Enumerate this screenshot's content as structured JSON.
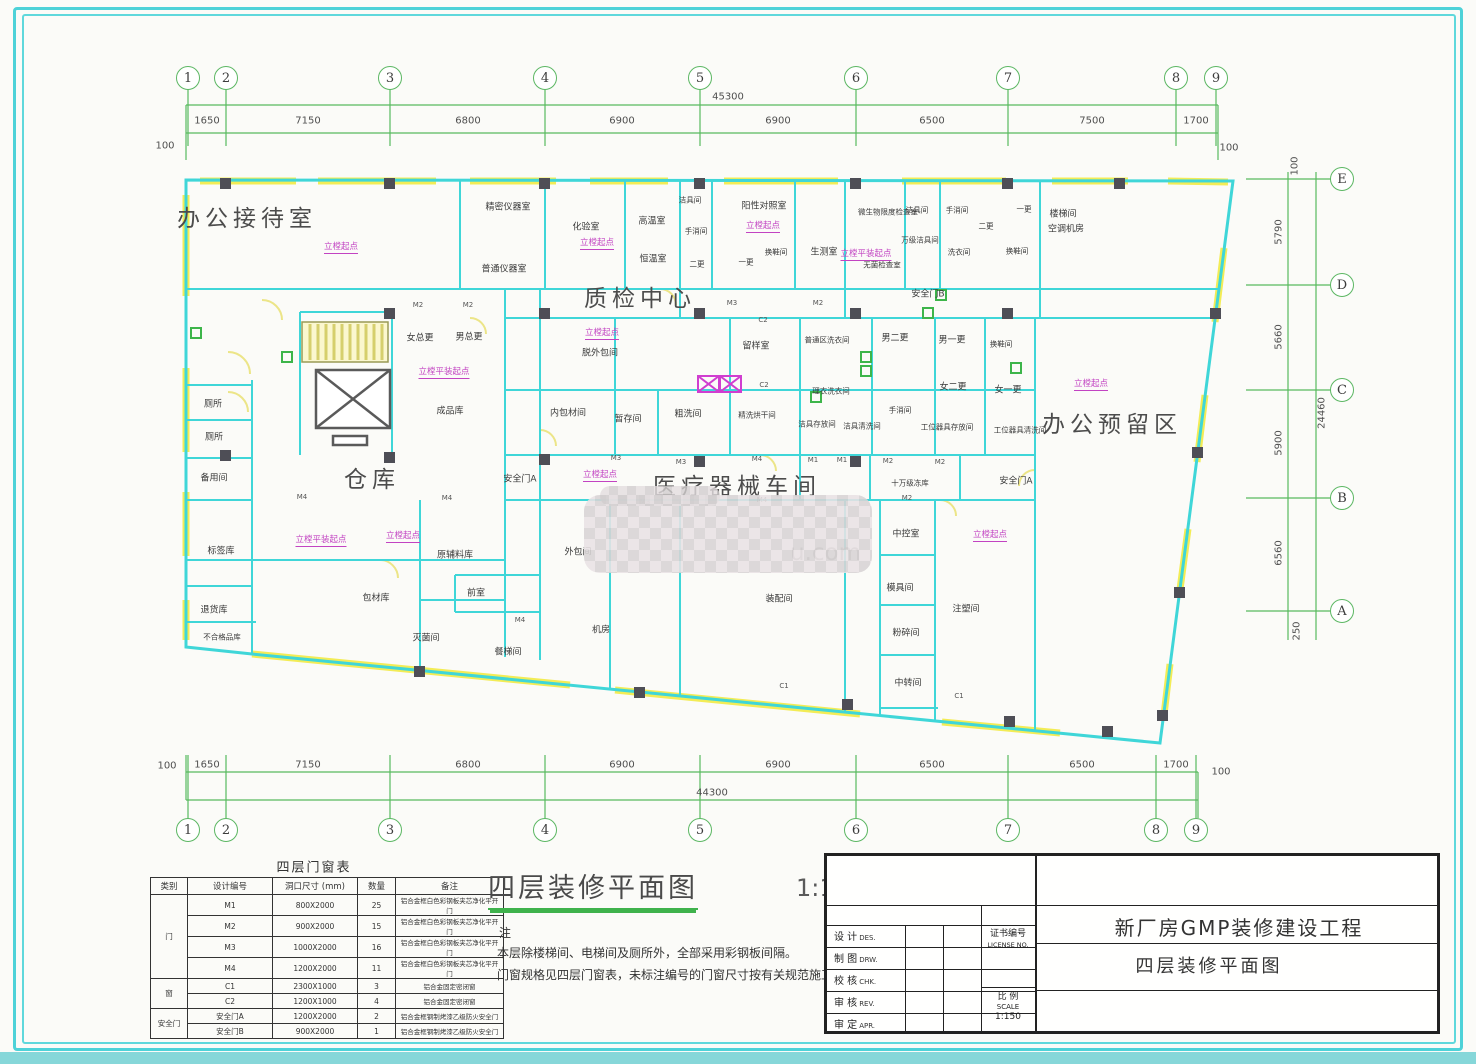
{
  "plan_title": {
    "text": "四层装修平面图",
    "scale": "1:150"
  },
  "watermark": {
    "text": "u.com"
  },
  "notes": {
    "marker": "注",
    "lines": [
      "本层除楼梯间、电梯间及厕所外，全部采用彩钢板间隔。",
      "门窗规格见四层门窗表，未标注编号的门窗尺寸按有关规范施工。"
    ]
  },
  "axes": {
    "top": {
      "items": [
        {
          "n": "1",
          "x": 188
        },
        {
          "n": "2",
          "x": 226
        },
        {
          "n": "3",
          "x": 390
        },
        {
          "n": "4",
          "x": 545
        },
        {
          "n": "5",
          "x": 700
        },
        {
          "n": "6",
          "x": 856
        },
        {
          "n": "7",
          "x": 1008
        },
        {
          "n": "8",
          "x": 1176
        },
        {
          "n": "9",
          "x": 1216
        }
      ],
      "dims": [
        {
          "v": "1650",
          "x": 207
        },
        {
          "v": "7150",
          "x": 308
        },
        {
          "v": "6800",
          "x": 468
        },
        {
          "v": "6900",
          "x": 622
        },
        {
          "v": "6900",
          "x": 778
        },
        {
          "v": "6500",
          "x": 932
        },
        {
          "v": "7500",
          "x": 1092
        },
        {
          "v": "1700",
          "x": 1196
        }
      ],
      "total": {
        "v": "45300",
        "x": 728,
        "y": 97
      },
      "ends": [
        {
          "v": "100",
          "x": 165,
          "y": 146
        },
        {
          "v": "100",
          "x": 1229,
          "y": 148
        }
      ]
    },
    "bottom": {
      "items": [
        {
          "n": "1",
          "x": 188
        },
        {
          "n": "2",
          "x": 226
        },
        {
          "n": "3",
          "x": 390
        },
        {
          "n": "4",
          "x": 545
        },
        {
          "n": "5",
          "x": 700
        },
        {
          "n": "6",
          "x": 856
        },
        {
          "n": "7",
          "x": 1008
        },
        {
          "n": "8",
          "x": 1156
        },
        {
          "n": "9",
          "x": 1196
        }
      ],
      "dims": [
        {
          "v": "1650",
          "x": 207
        },
        {
          "v": "7150",
          "x": 308
        },
        {
          "v": "6800",
          "x": 468
        },
        {
          "v": "6900",
          "x": 622
        },
        {
          "v": "6900",
          "x": 778
        },
        {
          "v": "6500",
          "x": 932
        },
        {
          "v": "6500",
          "x": 1082
        },
        {
          "v": "1700",
          "x": 1176
        }
      ],
      "total": {
        "v": "44300",
        "x": 712,
        "y": 793
      },
      "ends": [
        {
          "v": "100",
          "x": 167,
          "y": 766
        },
        {
          "v": "100",
          "x": 1221,
          "y": 772
        }
      ]
    },
    "right": {
      "items": [
        {
          "n": "E",
          "y": 179
        },
        {
          "n": "D",
          "y": 285
        },
        {
          "n": "C",
          "y": 390
        },
        {
          "n": "B",
          "y": 498
        },
        {
          "n": "A",
          "y": 611
        }
      ],
      "dims": [
        {
          "v": "100",
          "x": 1295,
          "y": 166
        },
        {
          "v": "5790",
          "x": 1279,
          "y": 232
        },
        {
          "v": "5660",
          "x": 1279,
          "y": 337
        },
        {
          "v": "5900",
          "x": 1279,
          "y": 443
        },
        {
          "v": "6560",
          "x": 1279,
          "y": 553
        },
        {
          "v": "250",
          "x": 1297,
          "y": 631
        }
      ],
      "total": {
        "v": "24460",
        "x": 1322,
        "y": 413
      }
    }
  },
  "rooms": [
    {
      "t": "办公接待室",
      "x": 247,
      "y": 216,
      "c": "xl"
    },
    {
      "t": "质检中心",
      "x": 640,
      "y": 296,
      "c": "xl"
    },
    {
      "t": "仓库",
      "x": 372,
      "y": 477,
      "c": "xl"
    },
    {
      "t": "医疗器械车间",
      "x": 737,
      "y": 484,
      "c": "xl"
    },
    {
      "t": "办公预留区",
      "x": 1112,
      "y": 422,
      "c": "xl"
    },
    {
      "t": "精密仪器室",
      "x": 508,
      "y": 206
    },
    {
      "t": "普通仪器室",
      "x": 504,
      "y": 268
    },
    {
      "t": "化验室",
      "x": 586,
      "y": 226
    },
    {
      "t": "高温室",
      "x": 652,
      "y": 220
    },
    {
      "t": "恒温室",
      "x": 653,
      "y": 258
    },
    {
      "t": "洁具间",
      "x": 690,
      "y": 200,
      "c": "sm"
    },
    {
      "t": "手消间",
      "x": 696,
      "y": 231,
      "c": "sm"
    },
    {
      "t": "二更",
      "x": 697,
      "y": 264,
      "c": "sm"
    },
    {
      "t": "一更",
      "x": 746,
      "y": 262,
      "c": "sm"
    },
    {
      "t": "阳性对照室",
      "x": 764,
      "y": 205
    },
    {
      "t": "换鞋间",
      "x": 776,
      "y": 252,
      "c": "sm"
    },
    {
      "t": "生测室",
      "x": 824,
      "y": 251
    },
    {
      "t": "微生物限度检查室",
      "x": 888,
      "y": 212,
      "c": "sm"
    },
    {
      "t": "无菌检查室",
      "x": 882,
      "y": 265,
      "c": "sm"
    },
    {
      "t": "洁具间",
      "x": 917,
      "y": 210,
      "c": "sm"
    },
    {
      "t": "手消间",
      "x": 957,
      "y": 210,
      "c": "sm"
    },
    {
      "t": "二更",
      "x": 986,
      "y": 226,
      "c": "sm"
    },
    {
      "t": "一更",
      "x": 1024,
      "y": 209,
      "c": "sm"
    },
    {
      "t": "万级洁具间",
      "x": 920,
      "y": 240,
      "c": "sm"
    },
    {
      "t": "洗衣间",
      "x": 959,
      "y": 252,
      "c": "sm"
    },
    {
      "t": "换鞋间",
      "x": 1017,
      "y": 251,
      "c": "sm"
    },
    {
      "t": "楼梯间",
      "x": 1063,
      "y": 213
    },
    {
      "t": "空调机房",
      "x": 1066,
      "y": 228
    },
    {
      "t": "安全门B",
      "x": 928,
      "y": 293
    },
    {
      "t": "女总更",
      "x": 420,
      "y": 337
    },
    {
      "t": "男总更",
      "x": 469,
      "y": 336
    },
    {
      "t": "成品库",
      "x": 450,
      "y": 410
    },
    {
      "t": "脱外包间",
      "x": 600,
      "y": 352
    },
    {
      "t": "留样室",
      "x": 756,
      "y": 345
    },
    {
      "t": "普通区洗衣间",
      "x": 827,
      "y": 340,
      "c": "sm"
    },
    {
      "t": "男二更",
      "x": 895,
      "y": 337
    },
    {
      "t": "男一更",
      "x": 952,
      "y": 339
    },
    {
      "t": "换鞋间",
      "x": 1001,
      "y": 344,
      "c": "sm"
    },
    {
      "t": "女二更",
      "x": 953,
      "y": 386
    },
    {
      "t": "女一更",
      "x": 1008,
      "y": 389
    },
    {
      "t": "理衣洗衣间",
      "x": 831,
      "y": 391,
      "c": "sm"
    },
    {
      "t": "手消间",
      "x": 900,
      "y": 410,
      "c": "sm"
    },
    {
      "t": "洁具存放间",
      "x": 817,
      "y": 424,
      "c": "sm"
    },
    {
      "t": "洁具清洗间",
      "x": 862,
      "y": 426,
      "c": "sm"
    },
    {
      "t": "工位器具存放间",
      "x": 947,
      "y": 427,
      "c": "sm"
    },
    {
      "t": "工位器具清洗间",
      "x": 1020,
      "y": 430,
      "c": "sm"
    },
    {
      "t": "厕所",
      "x": 213,
      "y": 403
    },
    {
      "t": "厕所",
      "x": 214,
      "y": 436
    },
    {
      "t": "备用间",
      "x": 214,
      "y": 477
    },
    {
      "t": "内包材间",
      "x": 568,
      "y": 412
    },
    {
      "t": "暂存间",
      "x": 628,
      "y": 418
    },
    {
      "t": "粗洗间",
      "x": 688,
      "y": 413
    },
    {
      "t": "精洗烘干间",
      "x": 757,
      "y": 415,
      "c": "sm"
    },
    {
      "t": "十万级冻库",
      "x": 910,
      "y": 483,
      "c": "sm"
    },
    {
      "t": "安全门A",
      "x": 1016,
      "y": 480
    },
    {
      "t": "安全门A",
      "x": 520,
      "y": 478
    },
    {
      "t": "中控室",
      "x": 906,
      "y": 533
    },
    {
      "t": "模具间",
      "x": 900,
      "y": 587
    },
    {
      "t": "注塑间",
      "x": 966,
      "y": 608
    },
    {
      "t": "粉碎间",
      "x": 906,
      "y": 632
    },
    {
      "t": "中转间",
      "x": 908,
      "y": 682
    },
    {
      "t": "装配间",
      "x": 779,
      "y": 598
    },
    {
      "t": "机房",
      "x": 601,
      "y": 629
    },
    {
      "t": "外包间",
      "x": 578,
      "y": 551
    },
    {
      "t": "前室",
      "x": 476,
      "y": 592
    },
    {
      "t": "餐梯间",
      "x": 508,
      "y": 651
    },
    {
      "t": "灭菌间",
      "x": 426,
      "y": 637
    },
    {
      "t": "原辅料库",
      "x": 455,
      "y": 554
    },
    {
      "t": "包材库",
      "x": 376,
      "y": 597
    },
    {
      "t": "标签库",
      "x": 221,
      "y": 550
    },
    {
      "t": "退货库",
      "x": 214,
      "y": 609
    },
    {
      "t": "不合格品库",
      "x": 222,
      "y": 637,
      "c": "sm"
    },
    {
      "t": "C2",
      "x": 763,
      "y": 320,
      "c": "code"
    },
    {
      "t": "C2",
      "x": 764,
      "y": 385,
      "c": "code"
    },
    {
      "t": "C1",
      "x": 784,
      "y": 686,
      "c": "code"
    },
    {
      "t": "C1",
      "x": 959,
      "y": 696,
      "c": "code"
    },
    {
      "t": "M2",
      "x": 418,
      "y": 305,
      "c": "code"
    },
    {
      "t": "M2",
      "x": 468,
      "y": 305,
      "c": "code"
    },
    {
      "t": "M3",
      "x": 732,
      "y": 303,
      "c": "code"
    },
    {
      "t": "M2",
      "x": 818,
      "y": 303,
      "c": "code"
    },
    {
      "t": "M3",
      "x": 616,
      "y": 458,
      "c": "code"
    },
    {
      "t": "M3",
      "x": 681,
      "y": 462,
      "c": "code"
    },
    {
      "t": "M4",
      "x": 757,
      "y": 459,
      "c": "code"
    },
    {
      "t": "M1",
      "x": 813,
      "y": 460,
      "c": "code"
    },
    {
      "t": "M1",
      "x": 842,
      "y": 460,
      "c": "code"
    },
    {
      "t": "M2",
      "x": 888,
      "y": 461,
      "c": "code"
    },
    {
      "t": "M2",
      "x": 940,
      "y": 462,
      "c": "code"
    },
    {
      "t": "M3",
      "x": 645,
      "y": 502,
      "c": "code"
    },
    {
      "t": "M4",
      "x": 762,
      "y": 500,
      "c": "code"
    },
    {
      "t": "M2",
      "x": 907,
      "y": 498,
      "c": "code"
    },
    {
      "t": "M4",
      "x": 302,
      "y": 497,
      "c": "code"
    },
    {
      "t": "M4",
      "x": 447,
      "y": 498,
      "c": "code"
    },
    {
      "t": "M4",
      "x": 520,
      "y": 620,
      "c": "code"
    },
    {
      "t": "立樘起点",
      "x": 341,
      "y": 247,
      "c": "purple"
    },
    {
      "t": "立樘起点",
      "x": 597,
      "y": 243,
      "c": "purple"
    },
    {
      "t": "立樘起点",
      "x": 763,
      "y": 226,
      "c": "purple"
    },
    {
      "t": "立樘平装起点",
      "x": 866,
      "y": 254,
      "c": "purple"
    },
    {
      "t": "立樘平装起点",
      "x": 444,
      "y": 372,
      "c": "purple"
    },
    {
      "t": "立樘起点",
      "x": 602,
      "y": 333,
      "c": "purple"
    },
    {
      "t": "立樘起点",
      "x": 600,
      "y": 475,
      "c": "purple"
    },
    {
      "t": "立樘平装起点",
      "x": 321,
      "y": 540,
      "c": "purple"
    },
    {
      "t": "立樘起点",
      "x": 403,
      "y": 536,
      "c": "purple"
    },
    {
      "t": "立樘起点",
      "x": 1091,
      "y": 384,
      "c": "purple"
    },
    {
      "t": "立樘起点",
      "x": 990,
      "y": 535,
      "c": "purple"
    }
  ],
  "table": {
    "title": "四层门窗表",
    "headers": [
      "类别",
      "设计编号",
      "洞口尺寸 (mm)",
      "数量",
      "备注"
    ],
    "groups": [
      {
        "cat": "门",
        "rows": [
          [
            "M1",
            "800X2000",
            "25",
            "铝合金框白色彩钢板夹芯净化平开门"
          ],
          [
            "M2",
            "900X2000",
            "15",
            "铝合金框白色彩钢板夹芯净化平开门"
          ],
          [
            "M3",
            "1000X2000",
            "16",
            "铝合金框白色彩钢板夹芯净化平开门"
          ],
          [
            "M4",
            "1200X2000",
            "11",
            "铝合金框白色彩钢板夹芯净化平开门"
          ]
        ]
      },
      {
        "cat": "窗",
        "rows": [
          [
            "C1",
            "2300X1000",
            "3",
            "铝合金固定密闭窗"
          ],
          [
            "C2",
            "1200X1000",
            "4",
            "铝合金固定密闭窗"
          ]
        ]
      },
      {
        "cat": "安全门",
        "rows": [
          [
            "安全门A",
            "1200X2000",
            "2",
            "铝合金框钢制烤漆乙级防火安全门"
          ],
          [
            "安全门B",
            "900X2000",
            "1",
            "铝合金框钢制烤漆乙级防火安全门"
          ]
        ]
      }
    ]
  },
  "titleblock": {
    "project": "新厂房GMP装修建设工程",
    "drawing": "四层装修平面图",
    "roles": [
      {
        "zh": "设 计",
        "en": "DES."
      },
      {
        "zh": "制 图",
        "en": "DRW."
      },
      {
        "zh": "校 核",
        "en": "CHK."
      },
      {
        "zh": "审 核",
        "en": "REV."
      },
      {
        "zh": "审 定",
        "en": "APR."
      }
    ],
    "license": {
      "zh": "证书编号",
      "en": "LICENSE NO."
    },
    "scale": {
      "zh": "比 例",
      "en": "SCALE",
      "value": "1:150"
    }
  }
}
